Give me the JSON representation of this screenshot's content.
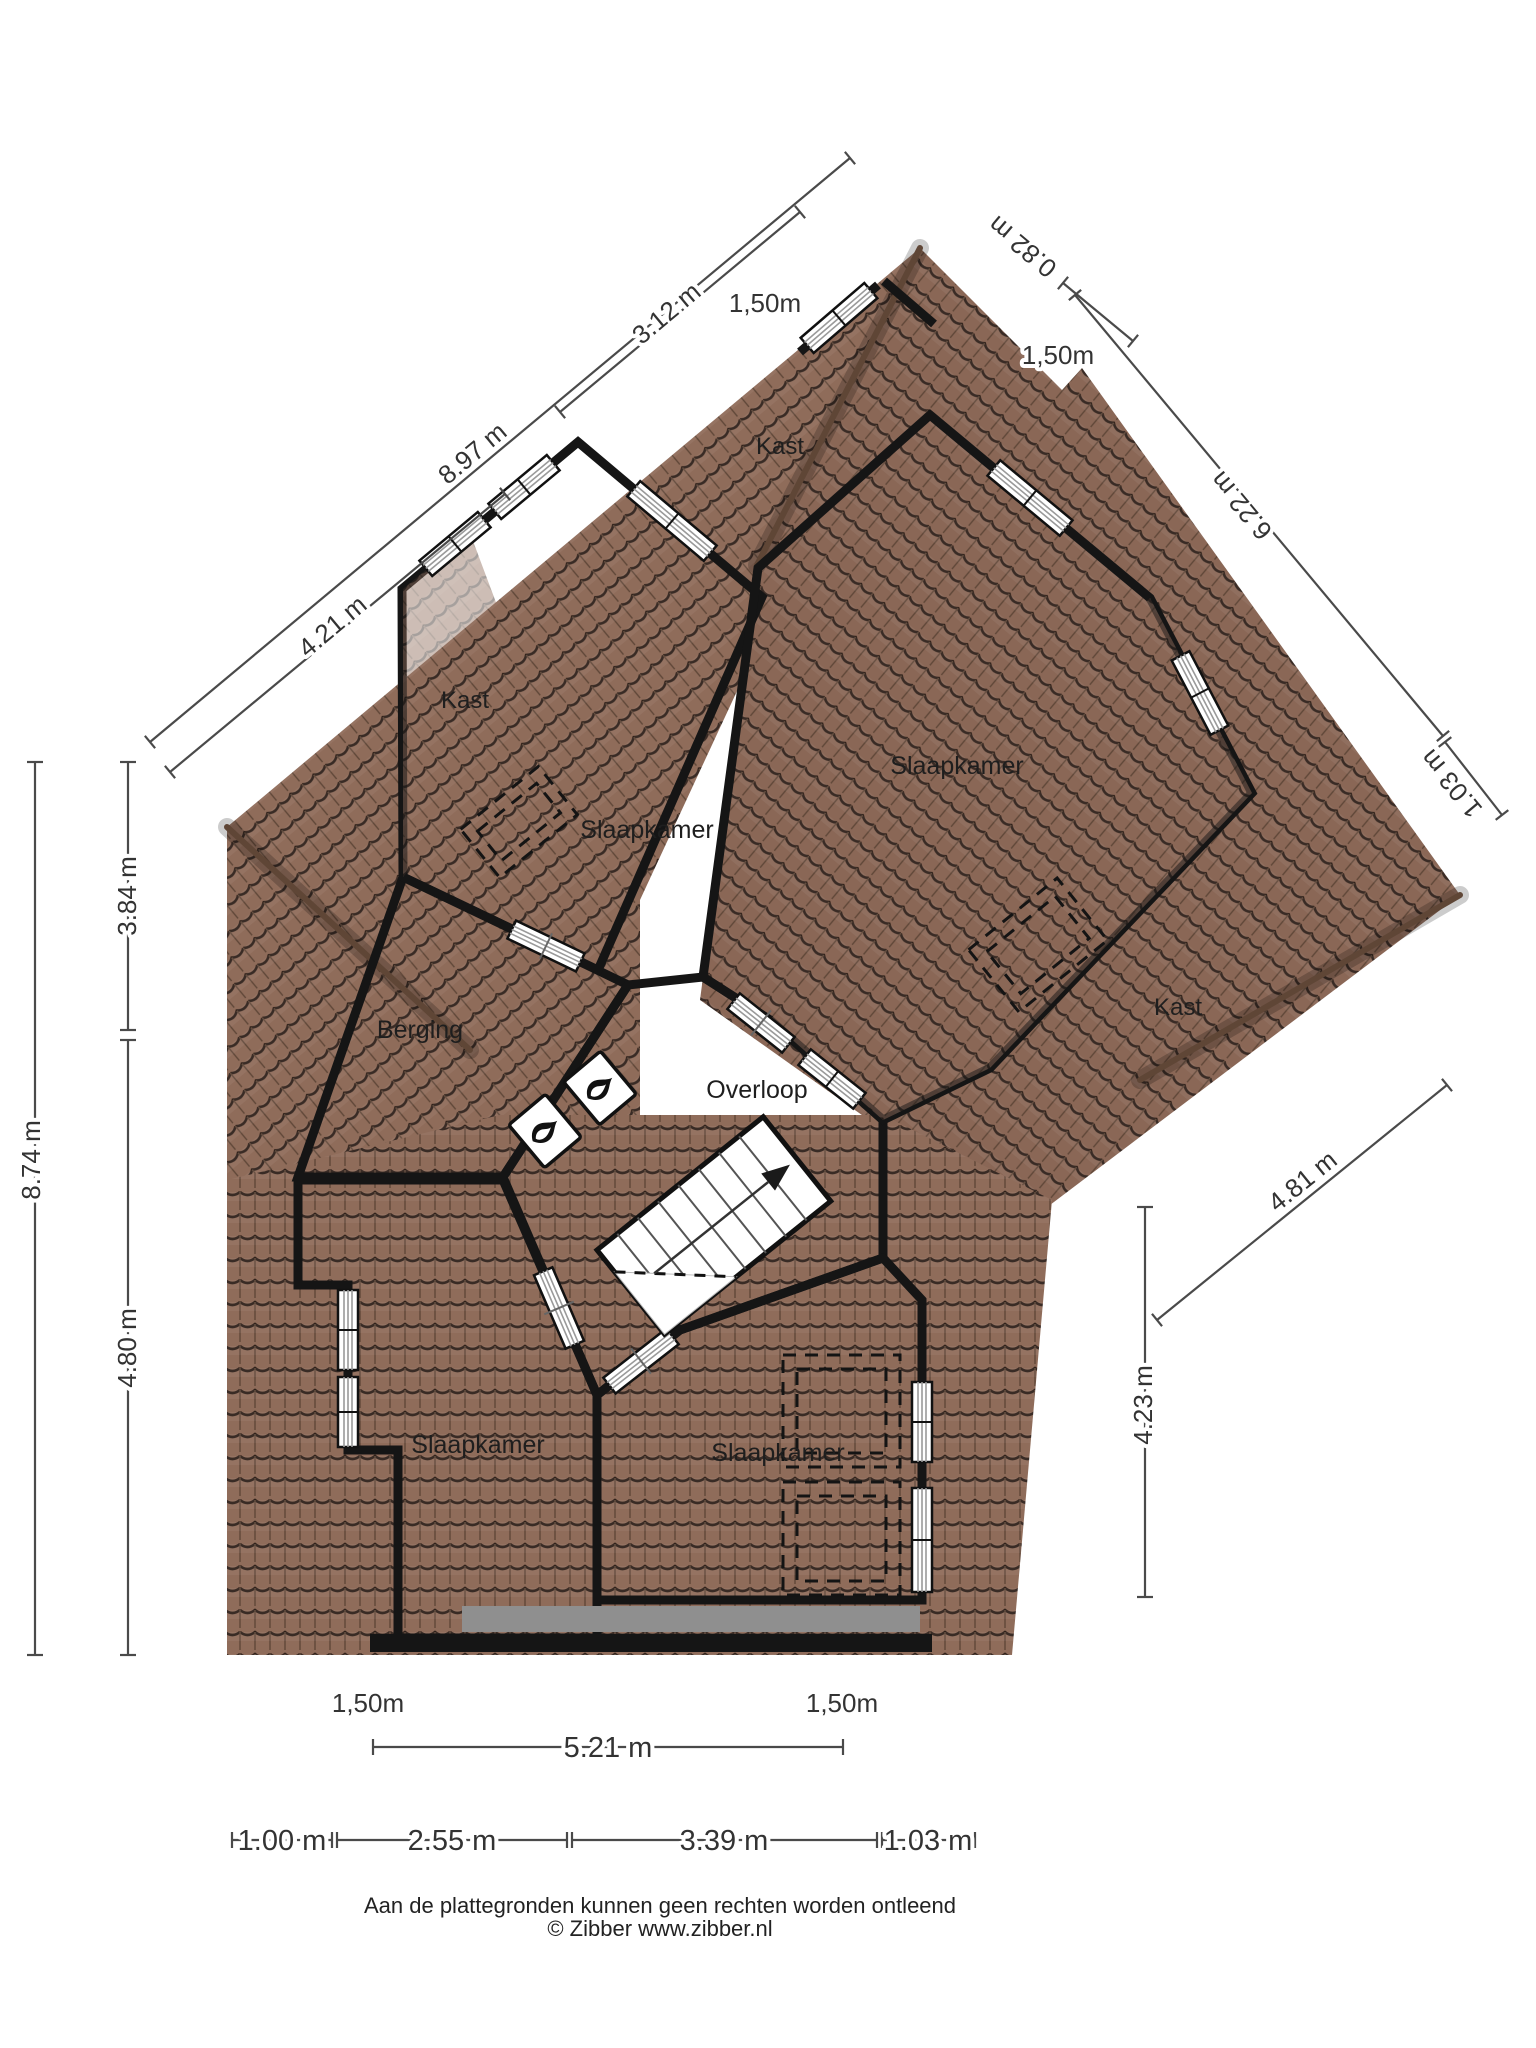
{
  "floorplan": {
    "rooms": {
      "slaapkamer_top_left": "Slaapkamer",
      "slaapkamer_top_right": "Slaapkamer",
      "slaapkamer_bottom_left": "Slaapkamer",
      "slaapkamer_bottom_center": "Slaapkamer",
      "berging": "Berging",
      "overloop": "Overloop",
      "kast_top": "Kast",
      "kast_left": "Kast",
      "kast_right": "Kast"
    },
    "dimensions": {
      "top_left_outer": "8.97 m",
      "top_left_mid": "3.12 m",
      "top_left_inner": "4.21 m",
      "top_height_left": "1,50m",
      "top_right_step": "0.82 m",
      "top_height_right": "1,50m",
      "right_eave": "6.22 m",
      "right_edge": "1.03 m",
      "left_outer": "8.74 m",
      "left_upper": "3.84 m",
      "left_lower": "4.80 m",
      "right_diag": "4.81 m",
      "right_lower": "4.23 m",
      "bottom_height_left": "1,50m",
      "bottom_height_right": "1,50m",
      "bottom_span": "5.21 m",
      "bottom_1": "1.00 m",
      "bottom_2": "2.55 m",
      "bottom_3": "3.39 m",
      "bottom_4": "1.03 m"
    },
    "footer": {
      "disclaimer": "Aan de plattegronden kunnen geen rechten worden ontleend",
      "credit": "© Zibber www.zibber.nl"
    },
    "colors": {
      "room_green": "#cce1b3",
      "room_gray": "#dcdcda",
      "room_tan": "#c5b59e",
      "roof_brown": "#8f6c5a",
      "wall_black": "#151515"
    }
  }
}
